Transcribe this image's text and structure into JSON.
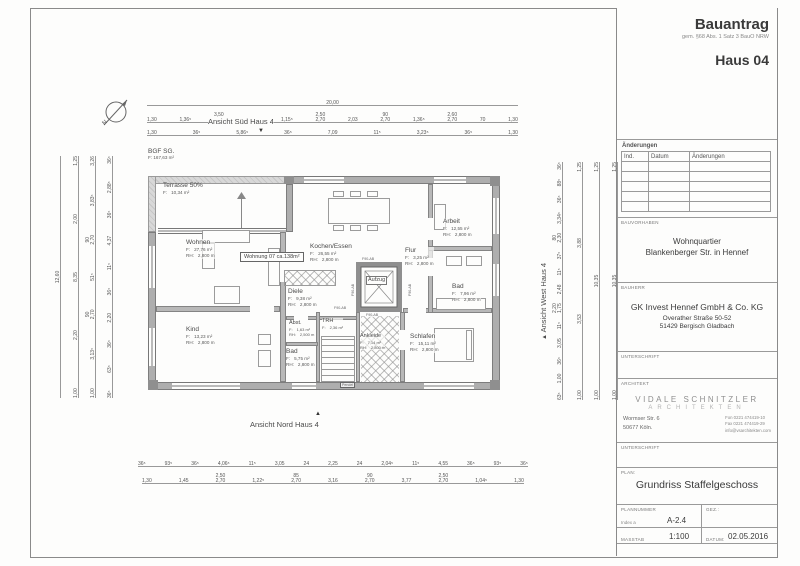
{
  "titleblock": {
    "doc_title": "Bauantrag",
    "doc_subtitle": "gem. §68 Abs. 1 Satz 3 BauO NRW",
    "house": "Haus 04",
    "aenderungen": {
      "label": "Änderungen",
      "columns": [
        "Ind.",
        "Datum",
        "Änderungen"
      ]
    },
    "bauvorhaben": {
      "label": "BAUVORHABEN",
      "line1": "Wohnquartier",
      "line2": "Blankenberger Str. in Hennef"
    },
    "bauherr": {
      "label": "BAUHERR",
      "name": "GK Invest Hennef GmbH & Co. KG",
      "street": "Overather Straße 50-52",
      "city": "51429 Bergisch Gladbach"
    },
    "unterschrift1": {
      "label": "UNTERSCHRIFT"
    },
    "architekt": {
      "label": "ARCHITEKT",
      "firm_line1": "VIDALE SCHNITZLER",
      "firm_line2": "ARCHITEKTEN",
      "street": "Wormser Str. 6",
      "city": "50677 Köln.",
      "fon": "Fon 0221 474419-10",
      "fax": "Fax 0221 474419-29",
      "email": "info@vsarchitekten.com"
    },
    "unterschrift2": {
      "label": "UNTERSCHRIFT"
    },
    "plan_sec": {
      "label": "PLAN:",
      "title": "Grundriss Staffelgeschoss"
    },
    "plannummer": {
      "label": "PLANNUMMER",
      "index": "Index a",
      "value": "A-2.4"
    },
    "gez": {
      "label": "GEZ.:"
    },
    "massstab": {
      "label": "MASSTAB",
      "value": "1:100"
    },
    "datum": {
      "label": "DATUM:",
      "value": "02.05.2016"
    }
  },
  "plan": {
    "labels": {
      "f": "F:",
      "rh": "RH:"
    },
    "bgf": {
      "title": "BGF SG.",
      "area": "F: 167,63 m²"
    },
    "ansicht_sued": "Ansicht Süd Haus 4",
    "ansicht_nord": "Ansicht Nord Haus 4",
    "ansicht_west": "Ansicht West Haus 4",
    "wohnung_label": "Wohnung 07 ca.138m²",
    "f90_label": "F90-AB",
    "pendel_label": "Pendel",
    "markers": {
      "sued": "▼",
      "nord": "▲",
      "west": "▲",
      "north_letter": "N"
    },
    "rooms": {
      "terrasse": {
        "name": "Terrasse 50%",
        "f": "10,34 m²"
      },
      "wohnen": {
        "name": "Wohnen",
        "f": "27,76 m²",
        "rh": "2,800 m"
      },
      "kind": {
        "name": "Kind",
        "f": "13,23 m²",
        "rh": "2,800 m"
      },
      "kochen": {
        "name": "Kochen/Essen",
        "f": "26,55 m²",
        "rh": "2,800 m"
      },
      "diele": {
        "name": "Diele",
        "f": "9,38 m²",
        "rh": "2,800 m"
      },
      "abst": {
        "name": "Abst.",
        "f": "1,63 m²",
        "rh": "2,500 m"
      },
      "bad1": {
        "name": "Bad",
        "f": "5,75 m²",
        "rh": "2,800 m"
      },
      "trh": {
        "name": "TRH",
        "f": "2,36 m²"
      },
      "aufzug": {
        "name": "Aufzug"
      },
      "ankleide": {
        "name": "Ankleide",
        "f": "7,14 m²",
        "rh": "2,800 m"
      },
      "flur": {
        "name": "Flur",
        "f": "3,25 m²",
        "rh": "2,800 m"
      },
      "arbeit": {
        "name": "Arbeit",
        "f": "12,55 m²",
        "rh": "2,800 m"
      },
      "bad2": {
        "name": "Bad",
        "f": "7,96 m²",
        "rh": "2,800 m"
      },
      "schlafen": {
        "name": "Schlafen",
        "f": "15,11 m²",
        "rh": "2,800 m"
      }
    },
    "dims": {
      "top_overall": [
        "20,00"
      ],
      "top_row1": [
        "1,30",
        "1,36⁵",
        "3,50\n2,70",
        "1,36⁵",
        "1,15⁵",
        "2,50\n2,70",
        "2,03",
        "90\n2,70",
        "1,36⁵",
        "2,60\n2,70",
        "70",
        "1,30"
      ],
      "top_row2": [
        "1,30",
        "36⁵",
        "5,86⁵",
        "36⁵",
        "7,09",
        "11⁵",
        "3,23⁵",
        "36⁵",
        "1,30"
      ],
      "bottom_row1": [
        "36⁵",
        "93⁵",
        "36⁵",
        "4,06⁵",
        "11⁵",
        "3,05",
        "24",
        "2,25",
        "24",
        "2,04⁵",
        "11⁵",
        "4,55",
        "36⁵",
        "93⁵",
        "36⁵"
      ],
      "bottom_row2": [
        "1,30",
        "1,45",
        "2,50\n2,70",
        "1,22⁵",
        "85\n2,70",
        "3,16",
        "90\n2,70",
        "3,77",
        "2,50\n2,70",
        "1,04⁵",
        "1,30"
      ],
      "left_outer": [
        "12,60"
      ],
      "left_mid": [
        "1,25",
        "2,00",
        "8,35",
        "2,20",
        "1,00"
      ],
      "left_inner": [
        "3,26",
        "3,83⁵",
        "90\n2,70",
        "51⁵",
        "90\n2,70",
        "3,13⁵",
        "1,00"
      ],
      "left_wall": [
        "36⁵",
        "2,88⁵",
        "36⁵",
        "4,37",
        "11⁵",
        "36⁵",
        "2,20",
        "36⁵",
        "63⁵",
        "36⁵"
      ],
      "right_wall": [
        "36⁵",
        "88⁵",
        "36⁵",
        "3,34⁵",
        "80\n2,30",
        "37⁵",
        "11⁵",
        "2,48",
        "2,20\n1,75",
        "11⁵",
        "3,05",
        "36⁵",
        "1,00",
        "63⁵"
      ],
      "right_mid": [
        "1,25",
        "3,88",
        "3,53",
        "1,00"
      ],
      "right_outer": [
        "1,25",
        "10,35",
        "1,00"
      ],
      "right_far": [
        "1,25",
        "10,35",
        "1,00"
      ]
    }
  }
}
